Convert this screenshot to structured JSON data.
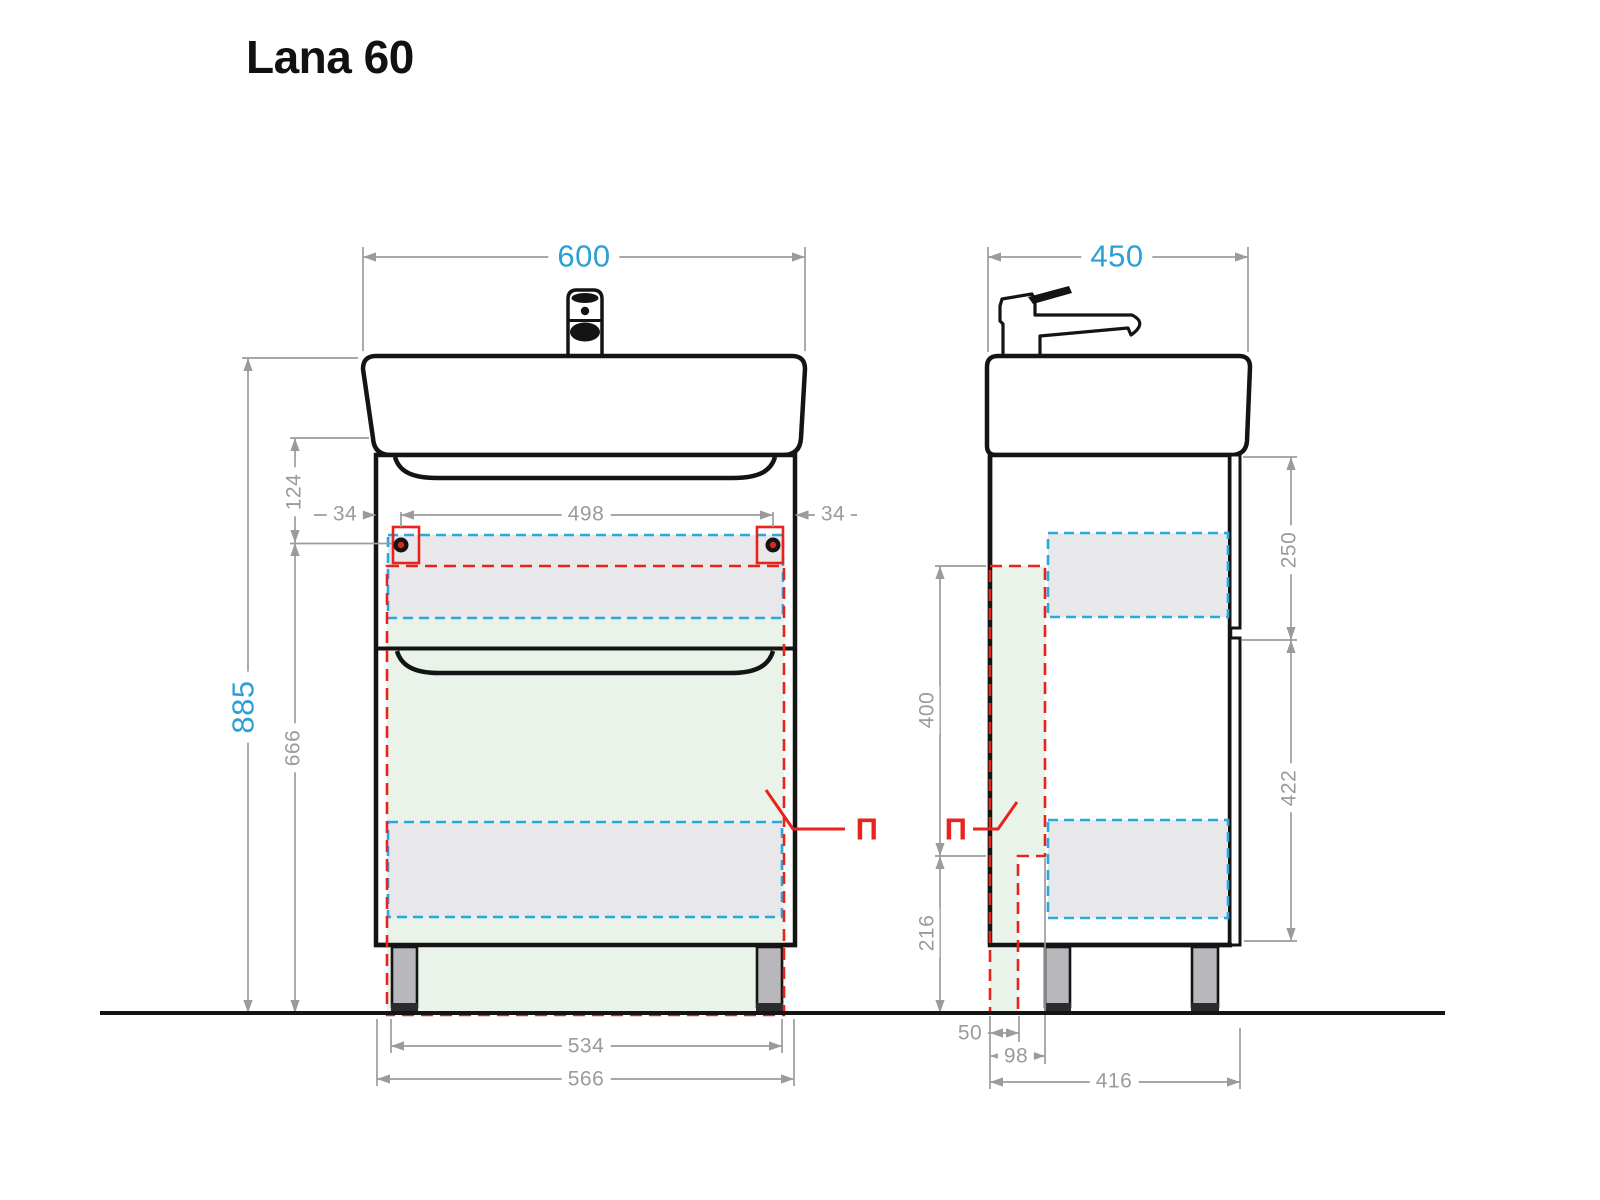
{
  "title": "Lana 60",
  "section_mark": "П",
  "front_view": {
    "dims": {
      "total_width": "600",
      "total_height": "885",
      "sink_to_holes": "124",
      "hole_inset_left": "34",
      "holes_span": "498",
      "hole_inset_right": "34",
      "holes_to_floor": "666",
      "legs_span": "534",
      "cabinet_width": "566"
    }
  },
  "side_view": {
    "dims": {
      "total_depth": "450",
      "drawer_height": "250",
      "door_height": "422",
      "cutout_height": "400",
      "cutout_to_floor": "216",
      "step_depth": "50",
      "cutout_depth": "98",
      "cabinet_depth": "416"
    }
  },
  "colors": {
    "accent_blue": "#2b9fd6",
    "dashed_blue": "#29a8e0",
    "mark_red": "#e8231e",
    "dim_gray": "#9b9b9b",
    "fill_green": "#eaf3ea",
    "fill_gray": "#e8e8eb",
    "line_black": "#141414"
  }
}
